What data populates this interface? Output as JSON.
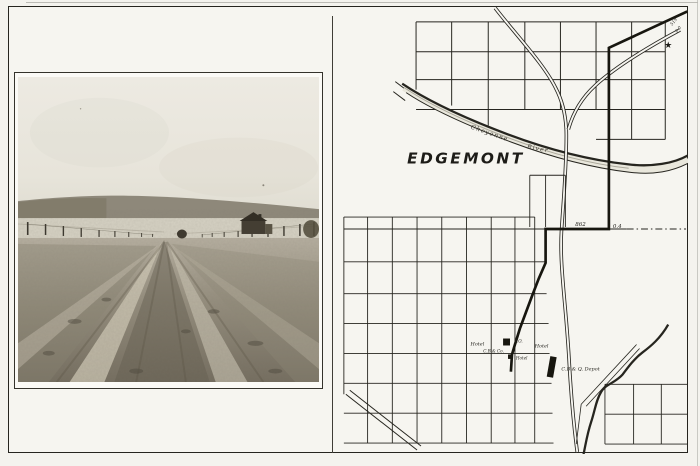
{
  "colors": {
    "paper": "#f4f3ee",
    "ink": "#26251f",
    "photo_sky": "#ebe8e0",
    "photo_hills": "#8e887a",
    "photo_field": "#d6d2c4",
    "photo_dirt_light": "#b3ac9b",
    "photo_dirt_dark": "#756e5f"
  },
  "photo": {
    "description": "Rutted dirt road running between wire fences toward low hills, farm buildings at right"
  },
  "map": {
    "town_name": "EDGEMONT",
    "river_name": {
      "first": "Cheyenne",
      "second": "River"
    },
    "poi": {
      "hotel_west": "Hotel",
      "post_office": "P.O.",
      "hotel_east": "Hotel",
      "store": "C.B.& Co.",
      "hotel_south": "Hotel",
      "depot": "C.B.& Q. Depot"
    },
    "mileage": {
      "jog_total": "862",
      "jog_interval": "0.4",
      "corner_top": "519",
      "corner_bottom": "0.0"
    },
    "star_glyph": "★"
  }
}
